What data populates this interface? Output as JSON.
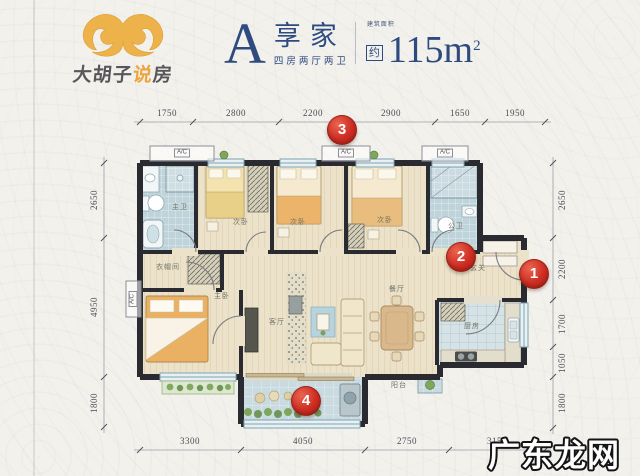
{
  "logo": {
    "brand_prefix": "大胡子",
    "brand_accent": "说",
    "brand_suffix": "房"
  },
  "header": {
    "plan_letter": "A",
    "plan_name": "享家",
    "plan_type": "四房两厅两卫",
    "area_note": "建筑面积",
    "area_approx": "约",
    "area_value": "115m",
    "area_exponent": "2"
  },
  "floorplan": {
    "ac_label": "A/C",
    "rooms": {
      "master_bath": "主卫",
      "closet": "衣帽间",
      "master_bedroom": "主卧",
      "bedroom_a": "次卧",
      "bedroom_b": "次卧",
      "bedroom_c": "次卧",
      "public_bath": "公卫",
      "entry": "玄关",
      "kitchen": "厨房",
      "dining": "餐厅",
      "living": "客厅",
      "balcony": "阳台"
    },
    "dimensions": {
      "top": [
        "1750",
        "2800",
        "2200",
        "2900",
        "1650",
        "1950"
      ],
      "bottom": [
        "3300",
        "4050",
        "2750",
        "3150"
      ],
      "left": [
        "2650",
        "4950",
        "1800"
      ],
      "right": [
        "2650",
        "2200",
        "1700",
        "1050",
        "1800"
      ]
    },
    "markers": [
      "1",
      "2",
      "3",
      "4"
    ]
  },
  "watermark": "广东龙网",
  "colors": {
    "accent_red": "#cd2d22",
    "title_navy": "#2e4b80",
    "logo_gold": "#eeb24b",
    "wall": "#2a2a31"
  }
}
